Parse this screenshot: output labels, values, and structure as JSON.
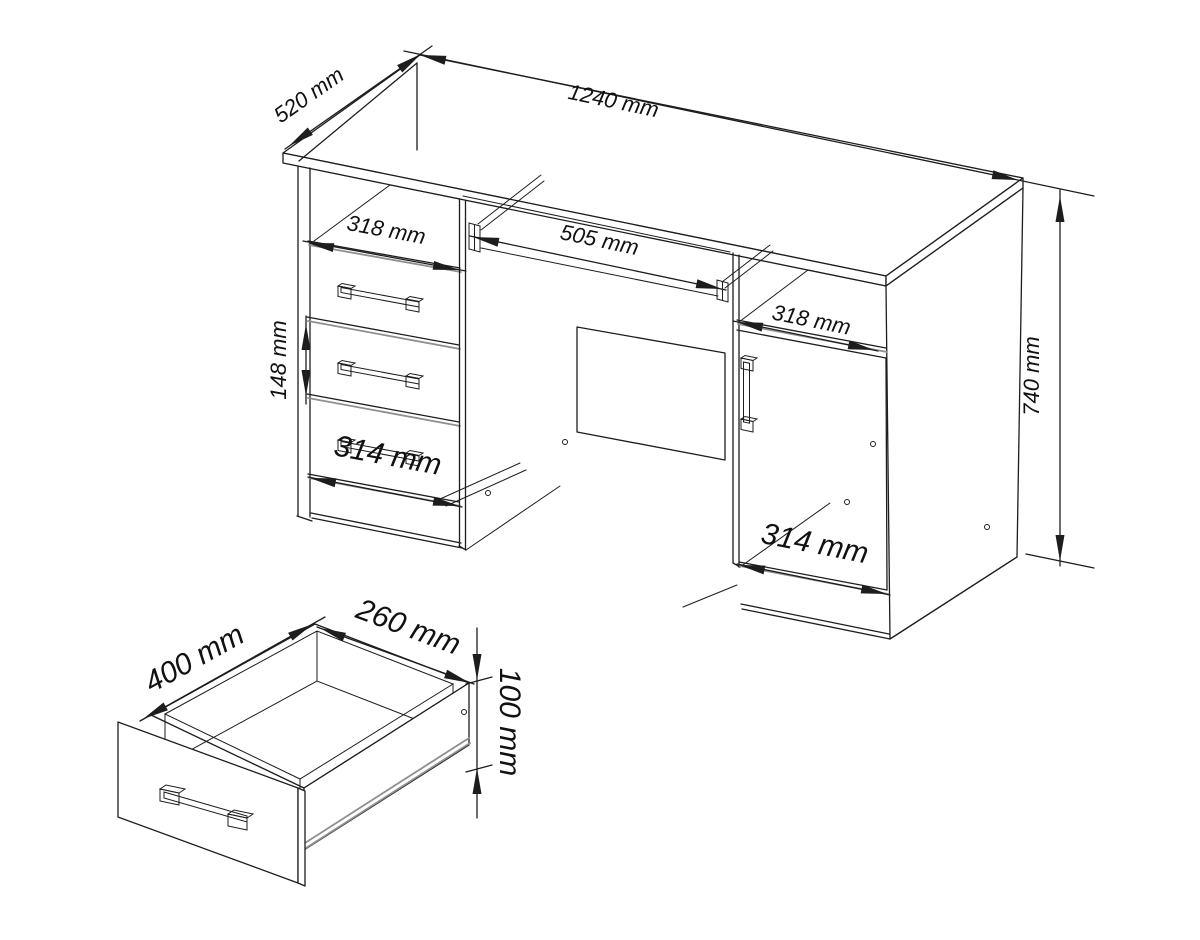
{
  "desk_view": {
    "dim_depth": "520 mm",
    "dim_width": "1240 mm",
    "dim_left_opening": "318 mm",
    "dim_tray": "505 mm",
    "dim_right_opening": "318 mm",
    "dim_drawer_height": "148 mm",
    "dim_left_front": "314 mm",
    "dim_right_front": "314 mm",
    "dim_height": "740 mm"
  },
  "drawer_view": {
    "dim_depth": "400 mm",
    "dim_width": "260 mm",
    "dim_height": "100 mm"
  },
  "colors": {
    "line": "#1d1d1d",
    "shading": "#8f8f8f",
    "background": "#ffffff"
  }
}
